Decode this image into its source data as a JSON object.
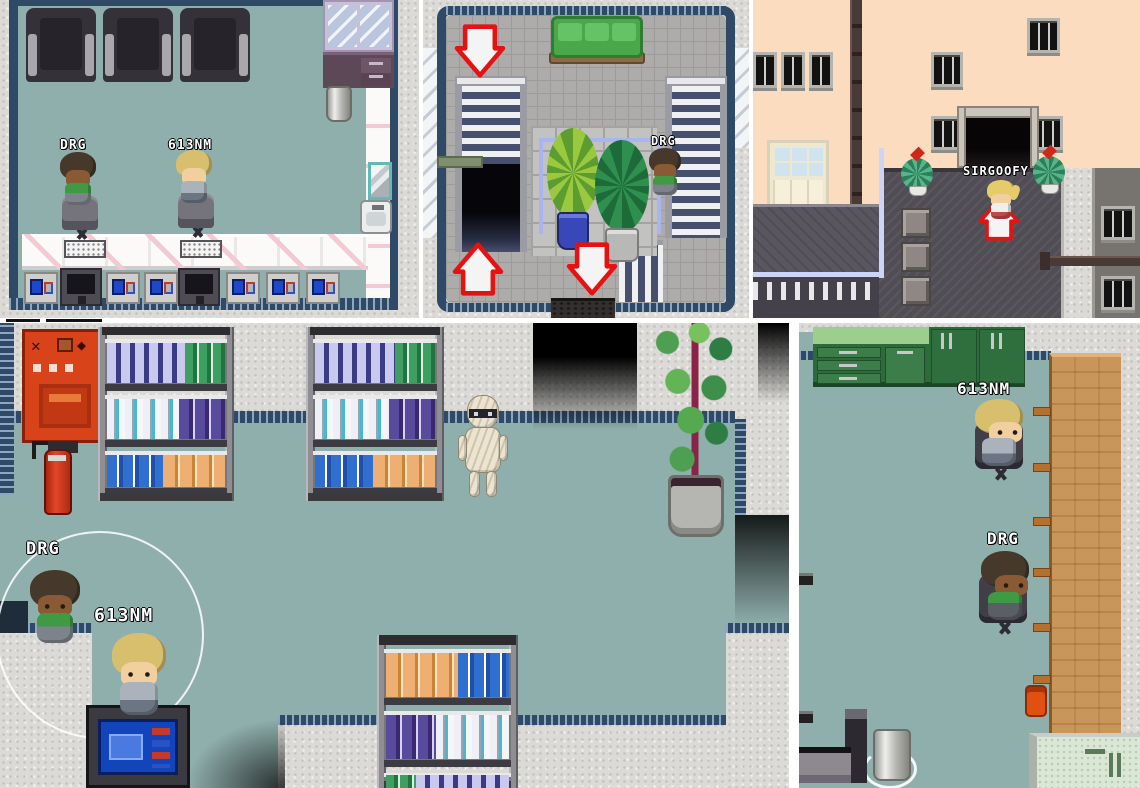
{
  "game": {
    "panels": [
      {
        "id": "cyber-cafe-room",
        "players": [
          {
            "name": "DRG"
          },
          {
            "name": "613NM"
          }
        ]
      },
      {
        "id": "stairwell-room",
        "players": [
          {
            "name": "DRG"
          }
        ],
        "arrows": [
          "down",
          "up",
          "down"
        ]
      },
      {
        "id": "street-entrance",
        "players": [
          {
            "name": "SIRGOOFY"
          }
        ],
        "arrows": [
          "up"
        ]
      },
      {
        "id": "shop-library-room",
        "players": [
          {
            "name": "DRG"
          },
          {
            "name": "613NM"
          }
        ],
        "npcs": [
          {
            "name": "mummy"
          }
        ]
      },
      {
        "id": "counter-office-room",
        "players": [
          {
            "name": "613NM"
          },
          {
            "name": "DRG"
          }
        ]
      }
    ],
    "colors": {
      "floor_teal": "#8FAFAC",
      "tile_gray": "#ADACAA",
      "wall_speckle": "#DBDAD7",
      "trim_navy": "#2F4A66",
      "arrow_red": "#E51212",
      "arrow_fill": "#F4F4F4",
      "vending_red": "#D8431A",
      "sofa_dark": "#34323A",
      "sofa_green": "#4FAE4F",
      "wood_counter": "#C9965A",
      "cabinet_green": "#2E6B3B",
      "wall_peach": "#FBDCBE",
      "roof_gray": "#534F55",
      "nametag_text": "#FFFFFF",
      "nametag_outline": "#000000"
    }
  }
}
